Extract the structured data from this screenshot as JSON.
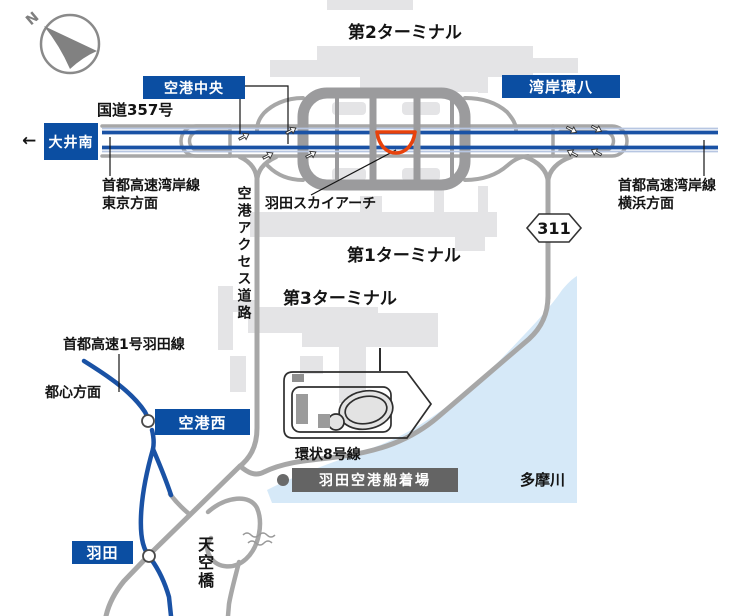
{
  "compass": {
    "north_letter": "N"
  },
  "icons": {
    "west_arrow": "←"
  },
  "badges": {
    "oi_minami": "大井南",
    "kuko_chuo": "空港中央",
    "wangan_kanpachi": "湾岸環八",
    "kuko_nishi": "空港西",
    "haneda": "羽田",
    "route_311": "311",
    "funatsukiba": "羽田空港船着場"
  },
  "labels": {
    "terminal2": "第2ターミナル",
    "terminal1": "第1ターミナル",
    "terminal3": "第3ターミナル",
    "route357": "国道357号",
    "wangan_line_tokyo": "首都高速湾岸線",
    "wangan_dir_tokyo": "東京方面",
    "wangan_line_yokohama": "首都高速湾岸線",
    "wangan_dir_yokohama": "横浜方面",
    "sky_arch": "羽田スカイアーチ",
    "access_road": "空港アクセス道路",
    "haneda_line": "首都高速1号羽田線",
    "toshin": "都心方面",
    "kanjo8": "環状8号線",
    "tamagawa": "多摩川",
    "tenkubashi": "天空橋"
  },
  "colors": {
    "badge_blue": "#0b4ea2",
    "badge_gray": "#646464",
    "expressway_blue": "#1a52a5",
    "expressway_light_stripe": "#b7c6e2",
    "road_gray": "#a7a7a7",
    "ring_gray": "#9b9b9d",
    "building_gray": "#e4e4e6",
    "river_blue": "#d6e9f8",
    "sky_arch_red": "#e8420c",
    "text_dark": "#141414"
  }
}
